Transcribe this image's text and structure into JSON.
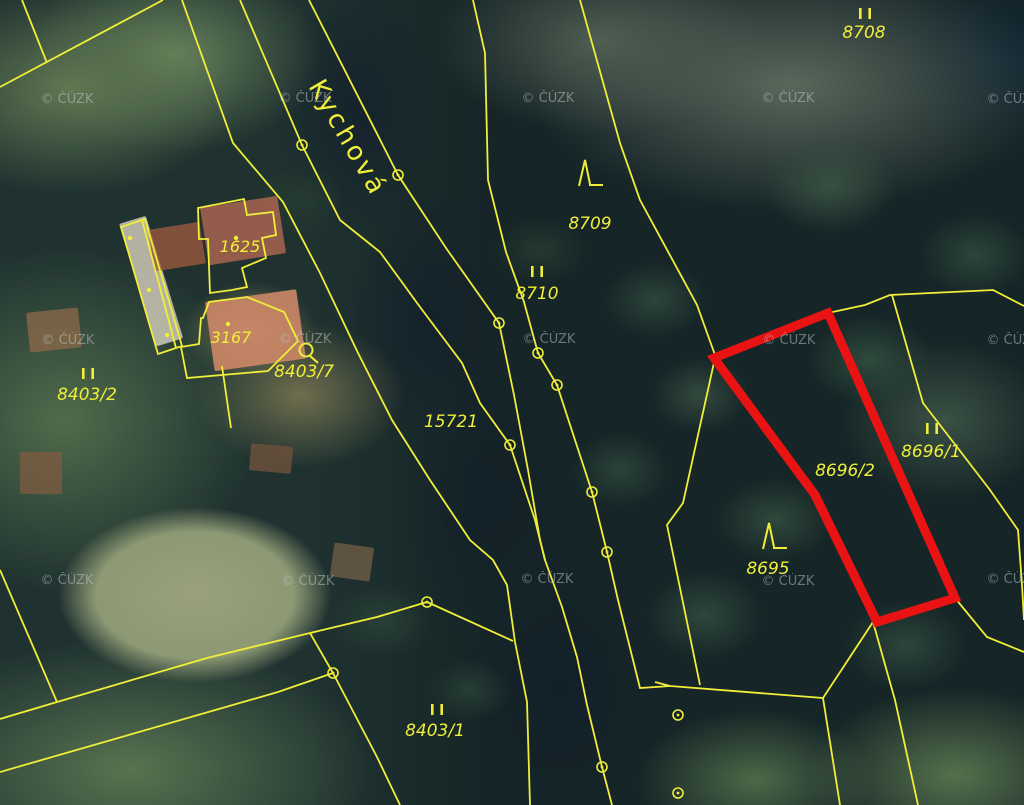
{
  "map": {
    "title": "cadastral-map-over-orthophoto",
    "colors": {
      "boundary": "#f0ee38",
      "highlight": "#e91313",
      "watermark": "#bfcacc"
    },
    "street_label": {
      "text": "Kychová",
      "x": 308,
      "y": 86,
      "rotation": 60
    },
    "watermark": {
      "text": "© ČÚZK",
      "positions": [
        [
          67,
          103
        ],
        [
          305,
          102
        ],
        [
          548,
          102
        ],
        [
          788,
          102
        ],
        [
          1013,
          103
        ],
        [
          68,
          344
        ],
        [
          305,
          343
        ],
        [
          549,
          343
        ],
        [
          789,
          344
        ],
        [
          1013,
          344
        ],
        [
          67,
          584
        ],
        [
          308,
          585
        ],
        [
          547,
          583
        ],
        [
          788,
          585
        ],
        [
          1013,
          583
        ]
      ]
    },
    "parcel_labels": [
      {
        "text": "8708",
        "x": 864,
        "y": 38
      },
      {
        "text": "8709",
        "x": 590,
        "y": 229
      },
      {
        "text": "8710",
        "x": 537,
        "y": 299
      },
      {
        "text": "15721",
        "x": 451,
        "y": 427
      },
      {
        "text": "8696/2",
        "x": 845,
        "y": 476
      },
      {
        "text": "8696/1",
        "x": 931,
        "y": 457
      },
      {
        "text": "8695",
        "x": 768,
        "y": 574
      },
      {
        "text": "8403/2",
        "x": 87,
        "y": 400
      },
      {
        "text": "8403/1",
        "x": 435,
        "y": 736
      },
      {
        "text": "8403/7",
        "x": 304,
        "y": 377
      },
      {
        "text": "1625",
        "x": 240,
        "y": 252,
        "small": true
      },
      {
        "text": "3167",
        "x": 231,
        "y": 343,
        "small": true
      }
    ],
    "landuse_marks": {
      "ii": [
        [
          865,
          8
        ],
        [
          537,
          266
        ],
        [
          932,
          423
        ],
        [
          88,
          368
        ],
        [
          437,
          704
        ]
      ],
      "tree": [
        [
          587,
          173
        ],
        [
          771,
          536
        ]
      ],
      "garden": [
        [
          306,
          350
        ]
      ]
    },
    "boundary_circles": [
      [
        302,
        145
      ],
      [
        398,
        175
      ],
      [
        499,
        323
      ],
      [
        538,
        353
      ],
      [
        557,
        385
      ],
      [
        510,
        445
      ],
      [
        592,
        492
      ],
      [
        607,
        552
      ],
      [
        427,
        602
      ],
      [
        333,
        673
      ],
      [
        602,
        767
      ],
      [
        678,
        715
      ],
      [
        678,
        793
      ]
    ],
    "building_dots": [
      [
        130,
        238
      ],
      [
        149,
        290
      ],
      [
        167,
        335
      ],
      [
        228,
        324
      ],
      [
        236,
        238
      ]
    ],
    "boundary_lines": [
      [
        [
          22,
          0
        ],
        [
          47,
          63
        ]
      ],
      [
        [
          163,
          0
        ],
        [
          0,
          87
        ]
      ],
      [
        [
          182,
          0
        ],
        [
          233,
          143
        ],
        [
          283,
          202
        ],
        [
          320,
          273
        ],
        [
          358,
          353
        ],
        [
          392,
          420
        ],
        [
          430,
          480
        ],
        [
          470,
          540
        ],
        [
          493,
          560
        ],
        [
          507,
          585
        ],
        [
          515,
          642
        ],
        [
          527,
          702
        ],
        [
          530,
          805
        ]
      ],
      [
        [
          240,
          0
        ],
        [
          302,
          145
        ],
        [
          340,
          220
        ],
        [
          380,
          252
        ],
        [
          420,
          307
        ],
        [
          462,
          363
        ],
        [
          480,
          403
        ],
        [
          510,
          445
        ],
        [
          535,
          520
        ],
        [
          545,
          560
        ],
        [
          562,
          607
        ],
        [
          577,
          657
        ],
        [
          587,
          705
        ],
        [
          602,
          767
        ],
        [
          612,
          805
        ]
      ],
      [
        [
          309,
          0
        ],
        [
          398,
          175
        ],
        [
          446,
          248
        ],
        [
          499,
          323
        ],
        [
          514,
          395
        ],
        [
          528,
          470
        ],
        [
          540,
          540
        ],
        [
          545,
          560
        ]
      ],
      [
        [
          473,
          0
        ],
        [
          485,
          53
        ],
        [
          488,
          180
        ],
        [
          506,
          252
        ],
        [
          524,
          302
        ],
        [
          538,
          353
        ],
        [
          557,
          385
        ],
        [
          592,
          492
        ],
        [
          607,
          552
        ],
        [
          618,
          600
        ],
        [
          640,
          688
        ],
        [
          670,
          686
        ]
      ],
      [
        [
          580,
          0
        ],
        [
          620,
          143
        ],
        [
          640,
          200
        ],
        [
          697,
          305
        ],
        [
          715,
          355
        ]
      ],
      [
        [
          715,
          358
        ],
        [
          683,
          503
        ],
        [
          667,
          525
        ],
        [
          700,
          685
        ]
      ],
      [
        [
          655,
          682
        ],
        [
          670,
          686
        ],
        [
          823,
          698
        ]
      ],
      [
        [
          823,
          698
        ],
        [
          873,
          622
        ]
      ],
      [
        [
          823,
          698
        ],
        [
          840,
          805
        ]
      ],
      [
        [
          873,
          622
        ],
        [
          895,
          700
        ],
        [
          918,
          805
        ]
      ],
      [
        [
          828,
          313
        ],
        [
          865,
          305
        ],
        [
          890,
          295
        ],
        [
          993,
          290
        ],
        [
          1024,
          306
        ]
      ],
      [
        [
          892,
          295
        ],
        [
          923,
          403
        ],
        [
          957,
          447
        ],
        [
          990,
          490
        ],
        [
          1018,
          530
        ],
        [
          1022,
          585
        ],
        [
          1024,
          620
        ]
      ],
      [
        [
          955,
          598
        ],
        [
          987,
          637
        ],
        [
          1024,
          652
        ]
      ],
      [
        [
          0,
          719
        ],
        [
          57,
          702
        ],
        [
          207,
          658
        ],
        [
          310,
          633
        ],
        [
          377,
          617
        ],
        [
          427,
          602
        ]
      ],
      [
        [
          0,
          570
        ],
        [
          57,
          702
        ]
      ],
      [
        [
          0,
          772
        ],
        [
          278,
          692
        ],
        [
          333,
          673
        ]
      ],
      [
        [
          310,
          633
        ],
        [
          333,
          673
        ],
        [
          377,
          757
        ],
        [
          400,
          805
        ]
      ],
      [
        [
          427,
          602
        ],
        [
          513,
          641
        ]
      ],
      [
        [
          222,
          366
        ],
        [
          231,
          428
        ]
      ]
    ],
    "building_outlines": [
      {
        "closed": true,
        "points": [
          [
            121,
            227
          ],
          [
            145,
            219
          ],
          [
            182,
            346
          ],
          [
            158,
            354
          ]
        ]
      },
      {
        "closed": false,
        "points": [
          [
            142,
            220
          ],
          [
            176,
            348
          ]
        ]
      },
      {
        "closed": true,
        "points": [
          [
            198,
            208
          ],
          [
            244,
            199
          ],
          [
            247,
            215
          ],
          [
            273,
            212
          ],
          [
            276,
            235
          ],
          [
            262,
            238
          ],
          [
            266,
            258
          ],
          [
            242,
            268
          ],
          [
            247,
            287
          ],
          [
            232,
            290
          ],
          [
            210,
            293
          ],
          [
            208,
            239
          ],
          [
            199,
            239
          ]
        ]
      },
      {
        "closed": true,
        "points": [
          [
            203,
            318
          ],
          [
            209,
            302
          ],
          [
            247,
            297
          ],
          [
            284,
            312
          ],
          [
            298,
            341
          ],
          [
            268,
            371
          ],
          [
            187,
            378
          ],
          [
            181,
            347
          ],
          [
            199,
            344
          ],
          [
            201,
            318
          ]
        ]
      }
    ],
    "highlight_parcel": {
      "number": "8696/2",
      "points": [
        [
          828,
          313
        ],
        [
          714,
          358
        ],
        [
          815,
          495
        ],
        [
          877,
          622
        ],
        [
          955,
          598
        ]
      ]
    }
  }
}
